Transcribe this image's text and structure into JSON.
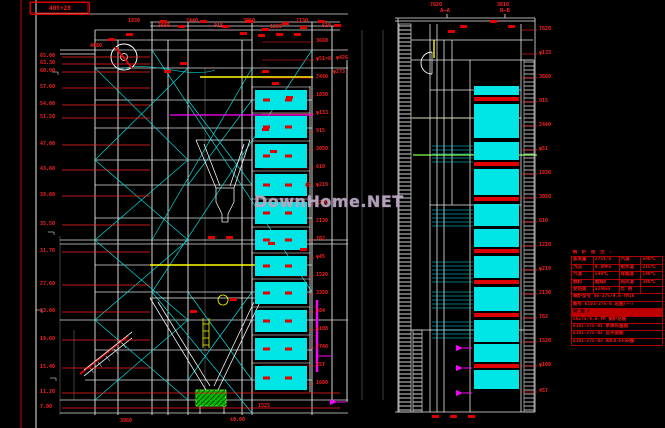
{
  "corner_label": {
    "text": "40t+28"
  },
  "watermark": {
    "text": "DownHome.NET",
    "scribble": "e"
  },
  "sections": {
    "a": "A—A",
    "b": "B—B"
  },
  "colors": {
    "line": "#e8e8e8",
    "cyan": "#00e5e5",
    "red": "#e00000",
    "dim_red": "#ff2020",
    "yellow": "#ffff00",
    "green": "#00c800",
    "magenta": "#ff00ff"
  },
  "elevations": [
    {
      "y": 57,
      "text": "65.00"
    },
    {
      "y": 64,
      "text": "63.30"
    },
    {
      "y": 72,
      "text": "60.90"
    },
    {
      "y": 88,
      "text": "57.60"
    },
    {
      "y": 105,
      "text": "54.00"
    },
    {
      "y": 118,
      "text": "51.50"
    },
    {
      "y": 145,
      "text": "47.00"
    },
    {
      "y": 170,
      "text": "43.60"
    },
    {
      "y": 196,
      "text": "39.80"
    },
    {
      "y": 225,
      "text": "35.50"
    },
    {
      "y": 252,
      "text": "31.70"
    },
    {
      "y": 285,
      "text": "27.60"
    },
    {
      "y": 312,
      "text": "23.80"
    },
    {
      "y": 340,
      "text": "19.60"
    },
    {
      "y": 368,
      "text": "15.40"
    },
    {
      "y": 393,
      "text": "11.20",
      "leader": 340
    },
    {
      "y": 408,
      "text": "7.00",
      "leader": 340
    }
  ],
  "dims_mid": [
    {
      "y": 42,
      "text": "3660"
    },
    {
      "y": 60,
      "text": "φ51×6"
    },
    {
      "y": 78,
      "text": "2440"
    },
    {
      "y": 96,
      "text": "1830"
    },
    {
      "y": 114,
      "text": "φ133"
    },
    {
      "y": 132,
      "text": "915"
    },
    {
      "y": 150,
      "text": "3050"
    },
    {
      "y": 168,
      "text": "610"
    },
    {
      "y": 186,
      "text": "φ219"
    },
    {
      "y": 204,
      "text": "1220"
    },
    {
      "y": 222,
      "text": "2130"
    },
    {
      "y": 240,
      "text": "762"
    },
    {
      "y": 258,
      "text": "φ45"
    },
    {
      "y": 276,
      "text": "1520"
    },
    {
      "y": 294,
      "text": "3350"
    },
    {
      "y": 312,
      "text": "584"
    },
    {
      "y": 330,
      "text": "φ108"
    },
    {
      "y": 348,
      "text": "2740"
    },
    {
      "y": 366,
      "text": "457"
    },
    {
      "y": 384,
      "text": "1680"
    }
  ],
  "dims_right": [
    {
      "y": 30,
      "text": "7620"
    },
    {
      "y": 54,
      "text": "φ133"
    },
    {
      "y": 78,
      "text": "3660"
    },
    {
      "y": 102,
      "text": "915"
    },
    {
      "y": 126,
      "text": "2440"
    },
    {
      "y": 150,
      "text": "φ51"
    },
    {
      "y": 174,
      "text": "1830"
    },
    {
      "y": 198,
      "text": "3050"
    },
    {
      "y": 222,
      "text": "610"
    },
    {
      "y": 246,
      "text": "1220"
    },
    {
      "y": 270,
      "text": "φ219"
    },
    {
      "y": 294,
      "text": "2130"
    },
    {
      "y": 318,
      "text": "762"
    },
    {
      "y": 342,
      "text": "1520"
    },
    {
      "y": 366,
      "text": "φ108"
    },
    {
      "y": 392,
      "text": "457"
    }
  ],
  "dims_top": [
    {
      "x": 128,
      "y": 19,
      "text": "1830"
    },
    {
      "x": 158,
      "y": 24,
      "text": "3660"
    },
    {
      "x": 186,
      "y": 19,
      "text": "2440"
    },
    {
      "x": 214,
      "y": 24,
      "text": "915"
    },
    {
      "x": 243,
      "y": 19,
      "text": "3050"
    },
    {
      "x": 270,
      "y": 25,
      "text": "1220"
    },
    {
      "x": 296,
      "y": 19,
      "text": "2130"
    },
    {
      "x": 322,
      "y": 24,
      "text": "610"
    },
    {
      "x": 430,
      "y": 3,
      "text": "7620"
    },
    {
      "x": 497,
      "y": 3,
      "text": "3810"
    },
    {
      "x": 90,
      "y": 44,
      "text": "4880"
    },
    {
      "x": 336,
      "y": 56,
      "text": "φ426"
    },
    {
      "x": 333,
      "y": 70,
      "text": "φ273"
    },
    {
      "x": 230,
      "y": 418,
      "text": "±0.00"
    },
    {
      "x": 258,
      "y": 404,
      "text": "1525"
    },
    {
      "x": 120,
      "y": 419,
      "text": "3960"
    }
  ],
  "banks_left": [
    {
      "y": 90,
      "h": 20
    },
    {
      "y": 116,
      "h": 22
    },
    {
      "y": 144,
      "h": 24
    },
    {
      "y": 174,
      "h": 22
    },
    {
      "y": 202,
      "h": 22
    },
    {
      "y": 230,
      "h": 20
    },
    {
      "y": 256,
      "h": 20
    },
    {
      "y": 282,
      "h": 22
    },
    {
      "y": 310,
      "h": 22
    },
    {
      "y": 338,
      "h": 22
    },
    {
      "y": 366,
      "h": 24
    }
  ],
  "banks_right": [
    {
      "y": 86,
      "h": 9,
      "t": "cyan"
    },
    {
      "y": 97,
      "h": 4,
      "t": "red"
    },
    {
      "y": 104,
      "h": 34,
      "t": "cyan"
    },
    {
      "y": 142,
      "h": 18,
      "t": "cyan"
    },
    {
      "y": 162,
      "h": 4,
      "t": "red"
    },
    {
      "y": 169,
      "h": 26,
      "t": "cyan"
    },
    {
      "y": 197,
      "h": 4,
      "t": "red"
    },
    {
      "y": 204,
      "h": 22,
      "t": "cyan"
    },
    {
      "y": 229,
      "h": 18,
      "t": "cyan"
    },
    {
      "y": 249,
      "h": 4,
      "t": "red"
    },
    {
      "y": 256,
      "h": 22,
      "t": "cyan"
    },
    {
      "y": 280,
      "h": 4,
      "t": "red"
    },
    {
      "y": 287,
      "h": 24,
      "t": "cyan"
    },
    {
      "y": 313,
      "h": 4,
      "t": "red"
    },
    {
      "y": 320,
      "h": 22,
      "t": "cyan"
    },
    {
      "y": 344,
      "h": 18,
      "t": "cyan"
    },
    {
      "y": 364,
      "h": 4,
      "t": "red"
    },
    {
      "y": 370,
      "h": 19,
      "t": "cyan"
    }
  ],
  "coils": [
    {
      "y0": 146,
      "y1": 164,
      "s": 4
    },
    {
      "y0": 210,
      "y1": 228,
      "s": 4
    },
    {
      "y0": 262,
      "y1": 282,
      "s": 4
    },
    {
      "y0": 292,
      "y1": 310,
      "s": 4
    },
    {
      "y0": 322,
      "y1": 338,
      "s": 4
    }
  ],
  "red_marks": [
    [
      160,
      20
    ],
    [
      178,
      25
    ],
    [
      200,
      20
    ],
    [
      222,
      25
    ],
    [
      246,
      20
    ],
    [
      262,
      28
    ],
    [
      282,
      22
    ],
    [
      300,
      26
    ],
    [
      318,
      20
    ],
    [
      334,
      24
    ],
    [
      240,
      32
    ],
    [
      258,
      34
    ],
    [
      276,
      33
    ],
    [
      294,
      33
    ],
    [
      262,
      70
    ],
    [
      272,
      82
    ],
    [
      262,
      128
    ],
    [
      270,
      150
    ],
    [
      286,
      96
    ],
    [
      448,
      30
    ],
    [
      460,
      25
    ],
    [
      490,
      20
    ],
    [
      508,
      25
    ],
    [
      108,
      38
    ],
    [
      126,
      33
    ],
    [
      208,
      236
    ],
    [
      226,
      236
    ],
    [
      190,
      310
    ],
    [
      230,
      298
    ],
    [
      432,
      415
    ],
    [
      450,
      415
    ],
    [
      468,
      415
    ],
    [
      300,
      248
    ],
    [
      268,
      242
    ],
    [
      180,
      62
    ],
    [
      164,
      70
    ]
  ],
  "magenta_arrows": [
    [
      456,
      348
    ],
    [
      456,
      368
    ],
    [
      456,
      393
    ],
    [
      330,
      402
    ]
  ],
  "spec_table": {
    "title": "锅 炉 规 范 :",
    "grid": [
      [
        "蒸发量",
        "275t/h",
        "汽温",
        "540℃"
      ],
      [
        "汽压",
        "9.8MPa",
        "给水温",
        "215℃"
      ],
      [
        "汽温",
        "540℃",
        "排烟温",
        "140℃"
      ],
      [
        "燃料",
        "烟煤Ⅱ",
        "热风温",
        "340℃"
      ],
      [
        "受热面",
        "5140㎡",
        "比 例",
        ""
      ]
    ],
    "rows": [
      {
        "text": "锅炉型号  SG-275/9.8-YM16"
      },
      {
        "text": "图号 E101-275-0  总图(一)"
      },
      {
        "text": "制 造 厂",
        "fill": true
      },
      {
        "text": "SG275/9.8-YM   锅炉总图"
      },
      {
        "text": "E101-275-01   本体布置图"
      },
      {
        "text": "E101-275-02   总平面图"
      },
      {
        "text": "E101-275-03   ABCD-EFGH图"
      }
    ]
  }
}
